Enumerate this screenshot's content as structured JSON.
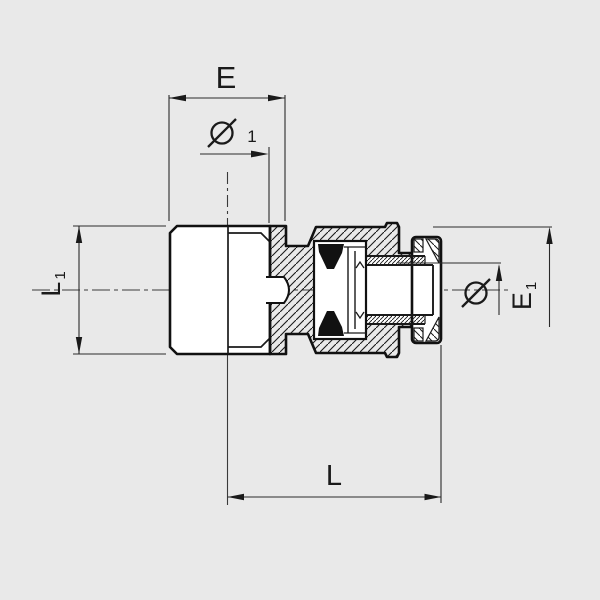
{
  "drawing": {
    "type": "technical-cross-section",
    "colors": {
      "background": "#e9e9e9",
      "outline": "#111111",
      "dim_line": "#2a2a2a",
      "centerline": "#3a3a3a",
      "seal_fill": "#111111"
    },
    "dimensions": {
      "e": {
        "label": "E"
      },
      "oe1": {
        "symbol": "Ø",
        "index": "1"
      },
      "l1": {
        "letter": "L",
        "index": "1"
      },
      "oe": {
        "symbol": "Ø"
      },
      "e1": {
        "letter": "E",
        "index": "1"
      },
      "l": {
        "label": "L"
      }
    }
  }
}
